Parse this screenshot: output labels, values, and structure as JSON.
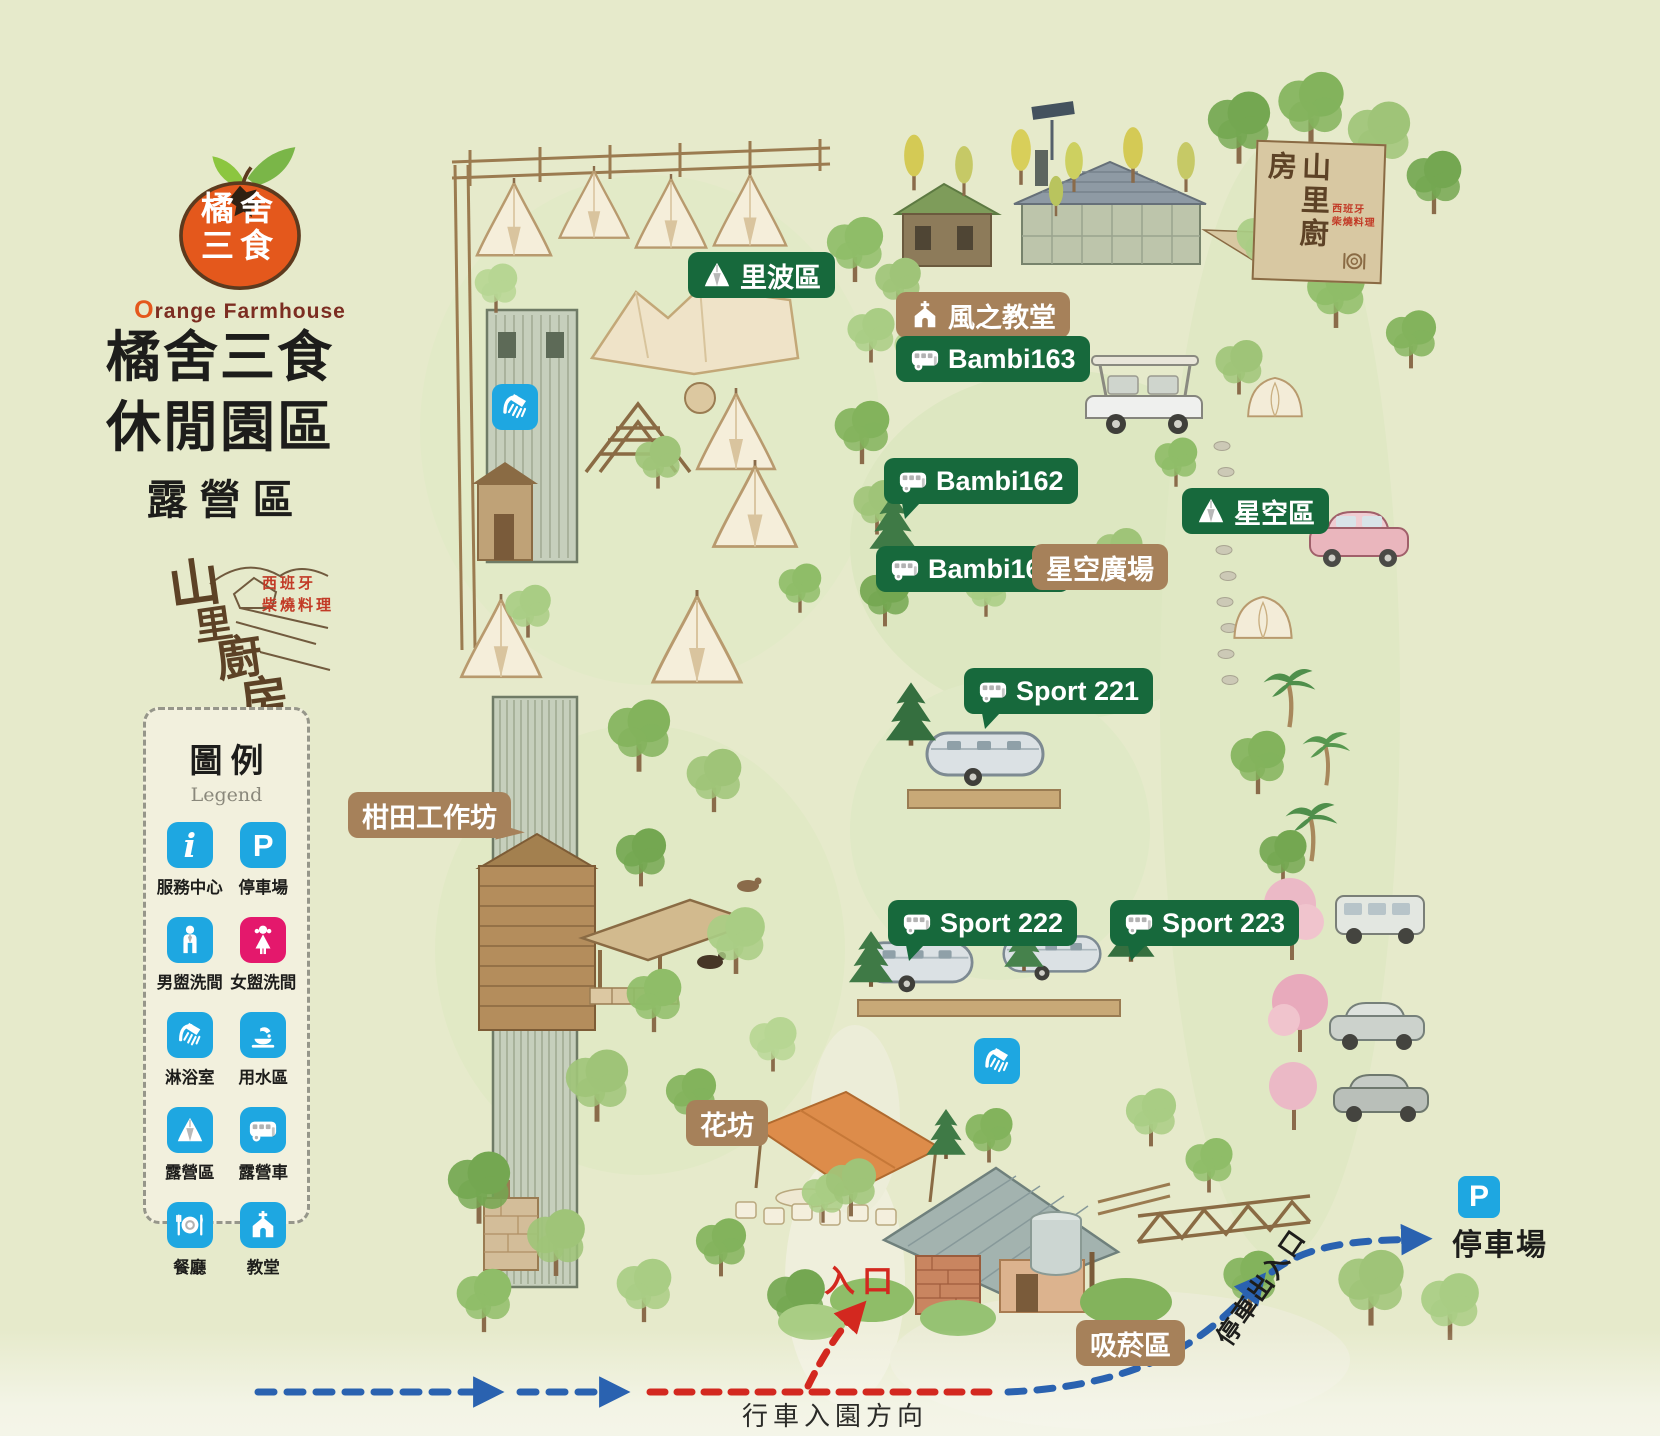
{
  "colors": {
    "background": "#e6eacb",
    "label_green": "#17693c",
    "label_brown": "#a6815a",
    "legend_blue": "#1ea7e1",
    "legend_pink": "#e4186c",
    "route_blue": "#2a62b0",
    "route_red": "#d3281f",
    "logo_orange": "#e4581c",
    "logo_dark_red": "#7c2d21"
  },
  "branding": {
    "logo_line1": "橘舍",
    "logo_line2": "三食",
    "logo_subtitle": "Orange Farmhouse",
    "title_line1": "橘舍三食",
    "title_line2": "休閒園區",
    "area_label": "露營區",
    "kitchen_name": "山里廚房",
    "kitchen_chars": [
      "山",
      "里",
      "廚",
      "房"
    ],
    "kitchen_tagline_line1": "西班牙",
    "kitchen_tagline_line2": "柴燒料理"
  },
  "legend": {
    "title": "圖例",
    "subtitle": "Legend",
    "items": [
      {
        "label": "服務中心",
        "icon": "info-icon",
        "glyph": "i",
        "color": "#1ea7e1"
      },
      {
        "label": "停車場",
        "icon": "parking-icon",
        "glyph": "P",
        "color": "#1ea7e1"
      },
      {
        "label": "男盥洗間",
        "icon": "men-restroom-icon",
        "color": "#1ea7e1"
      },
      {
        "label": "女盥洗間",
        "icon": "women-restroom-icon",
        "color": "#e4186c"
      },
      {
        "label": "淋浴室",
        "icon": "shower-icon",
        "color": "#1ea7e1"
      },
      {
        "label": "用水區",
        "icon": "water-icon",
        "color": "#1ea7e1"
      },
      {
        "label": "露營區",
        "icon": "tent-icon",
        "color": "#1ea7e1"
      },
      {
        "label": "露營車",
        "icon": "rv-icon",
        "color": "#1ea7e1"
      },
      {
        "label": "餐廳",
        "icon": "restaurant-icon",
        "color": "#1ea7e1"
      },
      {
        "label": "教堂",
        "icon": "church-icon",
        "color": "#1ea7e1"
      }
    ]
  },
  "map_labels": [
    {
      "text": "里波區",
      "style": "green",
      "icon": "tent"
    },
    {
      "text": "風之教堂",
      "style": "brown",
      "icon": "church"
    },
    {
      "text": "Bambi163",
      "style": "green",
      "icon": "rv"
    },
    {
      "text": "Bambi162",
      "style": "green",
      "icon": "rv"
    },
    {
      "text": "Bambi161",
      "style": "green",
      "icon": "rv"
    },
    {
      "text": "星空廣場",
      "style": "brown",
      "icon": "none"
    },
    {
      "text": "星空區",
      "style": "green",
      "icon": "tent"
    },
    {
      "text": "Sport 221",
      "style": "green",
      "icon": "rv"
    },
    {
      "text": "Sport 222",
      "style": "green",
      "icon": "rv"
    },
    {
      "text": "Sport 223",
      "style": "green",
      "icon": "rv"
    },
    {
      "text": "柑田工作坊",
      "style": "brown",
      "icon": "none"
    },
    {
      "text": "花坊",
      "style": "brown",
      "icon": "none"
    },
    {
      "text": "吸菸區",
      "style": "brown",
      "icon": "none"
    }
  ],
  "route": {
    "entrance_label": "入口",
    "direction_label": "行車入園方向",
    "parking_gate_label": "停車出入口",
    "parking_label": "停車場",
    "parking_glyph": "P"
  }
}
